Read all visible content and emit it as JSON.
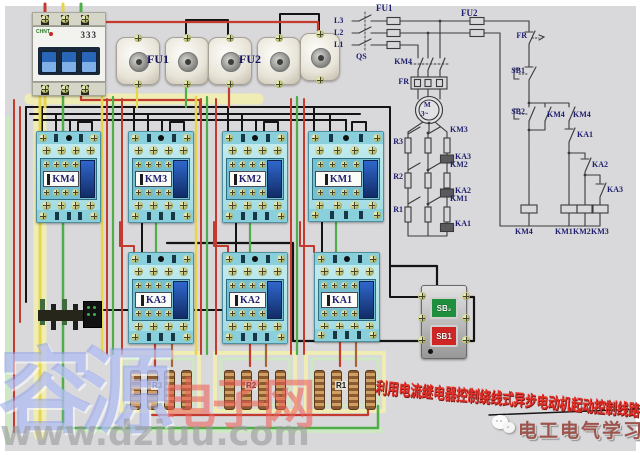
{
  "watermarks": {
    "brand_cn_big": "容源",
    "brand_cn_red": "电子网",
    "site_url": "www.dziuu.com"
  },
  "banner": {
    "title": "利用电流继电器控制绕线式异步电动机起动控制线路"
  },
  "footer": {
    "brand": "电工电气学习"
  },
  "hardware": {
    "breaker": {
      "brand": "CHNT",
      "marking": "333"
    },
    "fuse_group_labels": [
      "FU1",
      "FU2"
    ],
    "contactors": [
      "KM4",
      "KM3",
      "KM2",
      "KM1"
    ],
    "relays": [
      "KA3",
      "KA2",
      "KA1"
    ],
    "resistors": [
      "R3",
      "R2",
      "R1"
    ],
    "buttons": {
      "start": "SB₂",
      "stop": "SB1"
    }
  },
  "schematic": {
    "labels": [
      "L3",
      "L2",
      "L1",
      "QS",
      "FU1",
      "FU2",
      "KM4",
      "FR",
      "M",
      "3~",
      "KM3",
      "R3",
      "KA3",
      "KM2",
      "R2",
      "KA2",
      "KM1",
      "R1",
      "KA1",
      "FR",
      "SB1",
      "SB2",
      "KM4",
      "KM4",
      "KA1",
      "KA2",
      "KA3",
      "KM4",
      "KM1",
      "KM2",
      "KM3"
    ]
  },
  "colors": {
    "wire_red": "#c23b2e",
    "wire_green": "#4fae4a",
    "wire_yellow": "#e6d54f",
    "wire_black": "#141414",
    "wire_brown": "#a5653a",
    "highlight_yellow": "#efecb4",
    "highlight_green": "#cde8c2",
    "device_body": "#b9e6ea",
    "accent_blue": "#1d47cc",
    "schematic_ink": "#3a3a3a",
    "label_navy": "#1e1e6e",
    "title_red": "#e23028",
    "brand_maroon": "#9c544c"
  }
}
